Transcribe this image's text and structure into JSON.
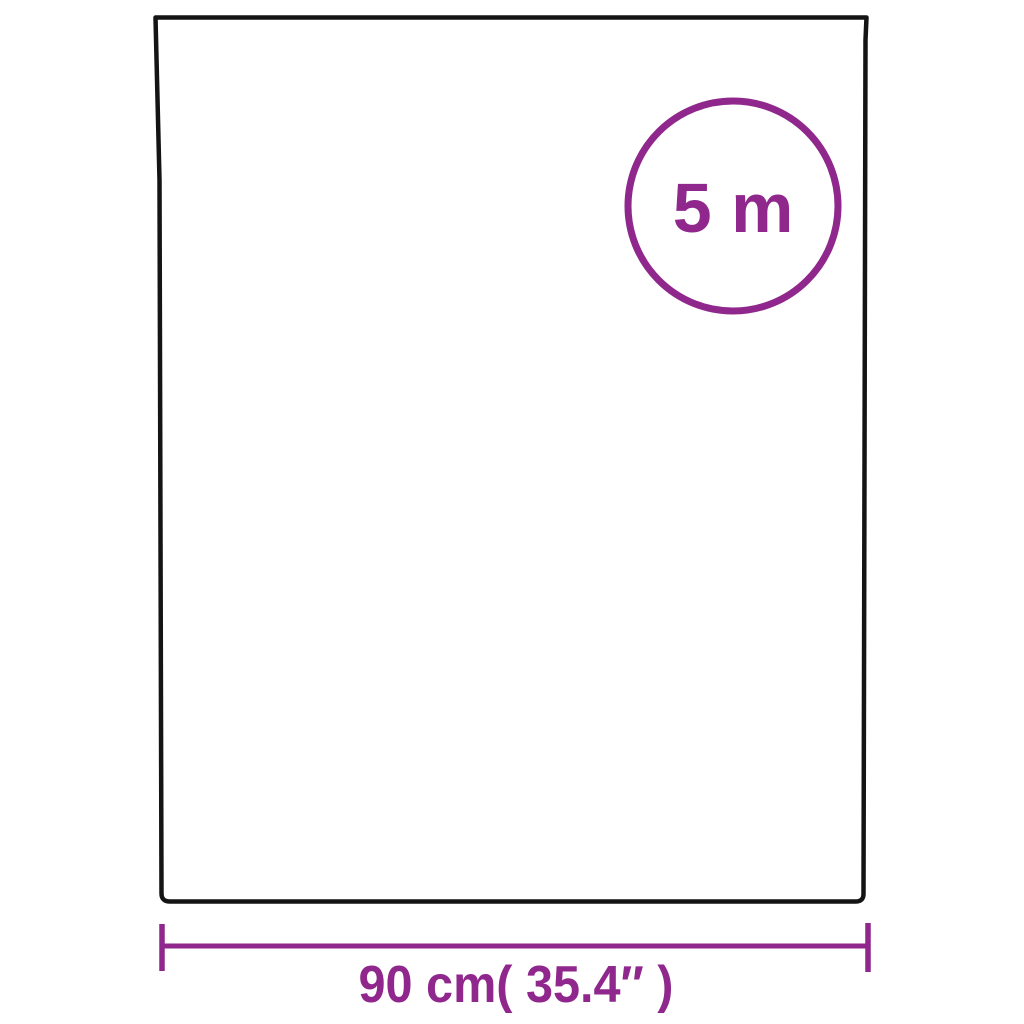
{
  "page": {
    "background": "#ffffff",
    "description_labels": {
      "badge_label": "5 m",
      "width_label": "90 cm( 35.4″ )"
    }
  },
  "colors": {
    "outline": "#141414",
    "accent": "#8F278C",
    "fill": "#ffffff"
  },
  "badge": {
    "label": "5 m"
  },
  "dimension": {
    "width_label": "90 cm( 35.4″ )"
  }
}
